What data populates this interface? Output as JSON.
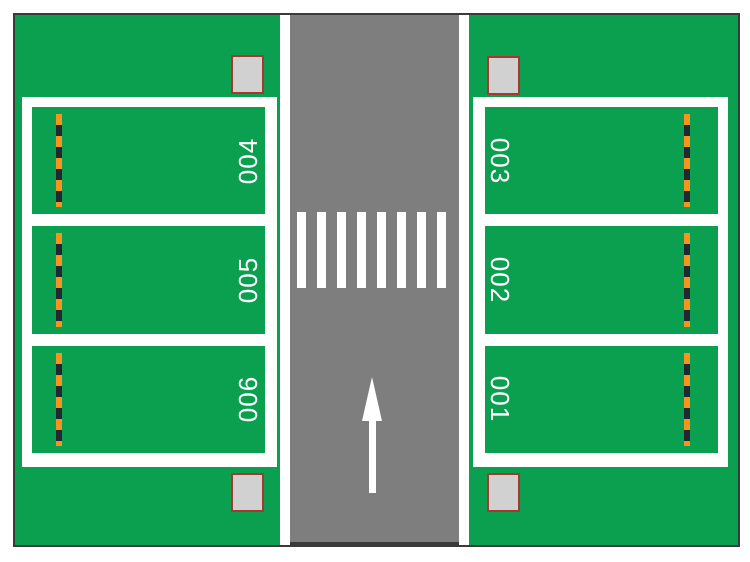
{
  "parking": {
    "left_spaces": [
      {
        "label": "004"
      },
      {
        "label": "005"
      },
      {
        "label": "006"
      }
    ],
    "right_spaces": [
      {
        "label": "003"
      },
      {
        "label": "002"
      },
      {
        "label": "001"
      }
    ],
    "road": {
      "crosswalk_stripe_count": 8,
      "arrow_direction": "up"
    },
    "marker_blocks": [
      "top-left",
      "top-right",
      "bottom-left",
      "bottom-right"
    ],
    "colors": {
      "grass_green": "#0aa050",
      "road_gray": "#7e7e7e",
      "line_white": "#ffffff",
      "dash_orange": "#f7941d",
      "dash_black": "#232730",
      "marker_fill": "#d1d1d1",
      "marker_border": "#a5392f",
      "outline_dark": "#3a3a3a"
    }
  }
}
